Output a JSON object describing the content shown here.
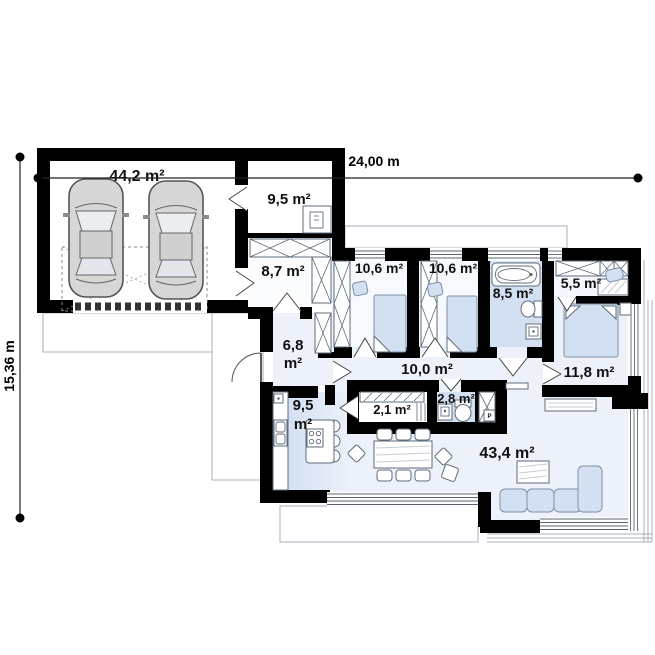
{
  "plan": {
    "type": "single-storey house floor plan with double garage",
    "overall_dimensions": {
      "width": "24,00 m",
      "height": "15,36 m"
    },
    "rooms": {
      "garage": "44,2 m²",
      "utility_room": "9,5 m²",
      "wardrobe_room": "8,7 m²",
      "bedroom_1": "10,6 m²",
      "bedroom_2": "10,6 m²",
      "bathroom": "8,5 m²",
      "dressing_room": "5,5 m²",
      "bedroom_3": "11,8 m²",
      "hall_value": "6,8",
      "hall_unit": "m²",
      "corridor": "10,0 m²",
      "kitchen_value": "9,5",
      "kitchen_unit": "m²",
      "pantry": "2,1 m²",
      "wc": "2,8 m²",
      "living_room": "43,4 m²"
    },
    "annotations": {
      "washing_machine": "P"
    },
    "colors": {
      "wall": "#000000",
      "floor_light": "#ecf1fa",
      "floor_blue": "#d3e0f2",
      "furniture_blue": "#d2e0f2",
      "outline_gray": "#a7afbd"
    }
  }
}
